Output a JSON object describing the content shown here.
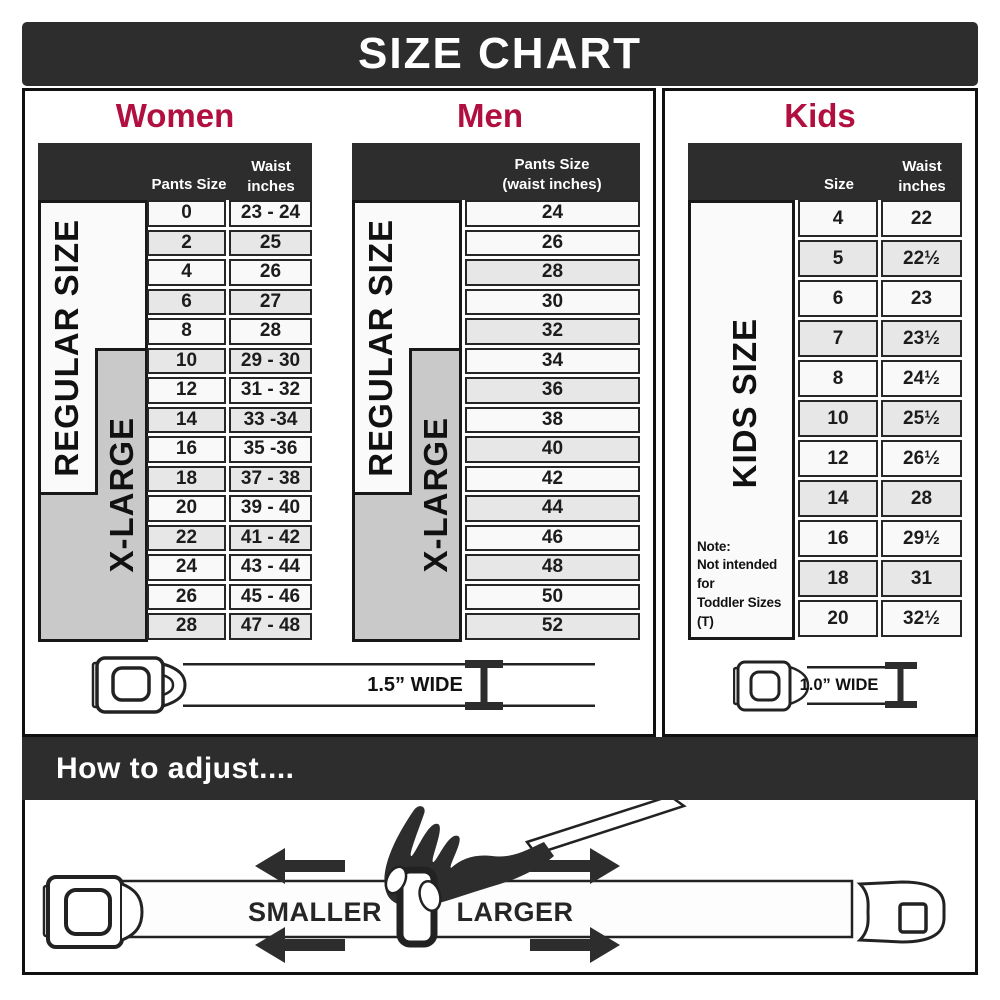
{
  "title": "SIZE CHART",
  "colors": {
    "accent_red": "#b10f3f",
    "dark_bar": "#2d2d2d",
    "label_gray": "#c9c9c9",
    "row_shaded": "#e7e7e7"
  },
  "women": {
    "heading": "Women",
    "col_pants": "Pants Size",
    "col_waist_line1": "Waist",
    "col_waist_line2": "inches",
    "label_regular": "REGULAR SIZE",
    "label_xlarge": "X-LARGE",
    "rows": [
      {
        "size": "0",
        "waist": "23 - 24",
        "shaded": false
      },
      {
        "size": "2",
        "waist": "25",
        "shaded": true
      },
      {
        "size": "4",
        "waist": "26",
        "shaded": false
      },
      {
        "size": "6",
        "waist": "27",
        "shaded": true
      },
      {
        "size": "8",
        "waist": "28",
        "shaded": false
      },
      {
        "size": "10",
        "waist": "29 - 30",
        "shaded": true
      },
      {
        "size": "12",
        "waist": "31 - 32",
        "shaded": false
      },
      {
        "size": "14",
        "waist": "33 -34",
        "shaded": true
      },
      {
        "size": "16",
        "waist": "35 -36",
        "shaded": false
      },
      {
        "size": "18",
        "waist": "37 - 38",
        "shaded": true
      },
      {
        "size": "20",
        "waist": "39 - 40",
        "shaded": false
      },
      {
        "size": "22",
        "waist": "41 - 42",
        "shaded": true
      },
      {
        "size": "24",
        "waist": "43 - 44",
        "shaded": false
      },
      {
        "size": "26",
        "waist": "45 - 46",
        "shaded": false
      },
      {
        "size": "28",
        "waist": "47 - 48",
        "shaded": true
      }
    ]
  },
  "men": {
    "heading": "Men",
    "col_line1": "Pants Size",
    "col_line2": "(waist inches)",
    "label_regular": "REGULAR SIZE",
    "label_xlarge": "X-LARGE",
    "rows": [
      {
        "size": "24",
        "shaded": false
      },
      {
        "size": "26",
        "shaded": false
      },
      {
        "size": "28",
        "shaded": true
      },
      {
        "size": "30",
        "shaded": false
      },
      {
        "size": "32",
        "shaded": true
      },
      {
        "size": "34",
        "shaded": false
      },
      {
        "size": "36",
        "shaded": true
      },
      {
        "size": "38",
        "shaded": false
      },
      {
        "size": "40",
        "shaded": true
      },
      {
        "size": "42",
        "shaded": false
      },
      {
        "size": "44",
        "shaded": true
      },
      {
        "size": "46",
        "shaded": false
      },
      {
        "size": "48",
        "shaded": true
      },
      {
        "size": "50",
        "shaded": false
      },
      {
        "size": "52",
        "shaded": true
      }
    ]
  },
  "kids": {
    "heading": "Kids",
    "col_size": "Size",
    "col_waist_line1": "Waist",
    "col_waist_line2": "inches",
    "label": "KIDS SIZE",
    "note_line1": "Note:",
    "note_line2": "Not intended for",
    "note_line3": "Toddler Sizes (T)",
    "rows": [
      {
        "size": "4",
        "waist": "22",
        "shaded": false
      },
      {
        "size": "5",
        "waist": "22½",
        "shaded": true
      },
      {
        "size": "6",
        "waist": "23",
        "shaded": false
      },
      {
        "size": "7",
        "waist": "23½",
        "shaded": true
      },
      {
        "size": "8",
        "waist": "24½",
        "shaded": false
      },
      {
        "size": "10",
        "waist": "25½",
        "shaded": true
      },
      {
        "size": "12",
        "waist": "26½",
        "shaded": false
      },
      {
        "size": "14",
        "waist": "28",
        "shaded": true
      },
      {
        "size": "16",
        "waist": "29½",
        "shaded": false
      },
      {
        "size": "18",
        "waist": "31",
        "shaded": true
      },
      {
        "size": "20",
        "waist": "32½",
        "shaded": false
      }
    ]
  },
  "belts": {
    "adult_width_label": "1.5” WIDE",
    "kids_width_label": "1.0” WIDE"
  },
  "adjust": {
    "heading": "How to adjust....",
    "smaller_label": "SMALLER",
    "larger_label": "LARGER"
  }
}
